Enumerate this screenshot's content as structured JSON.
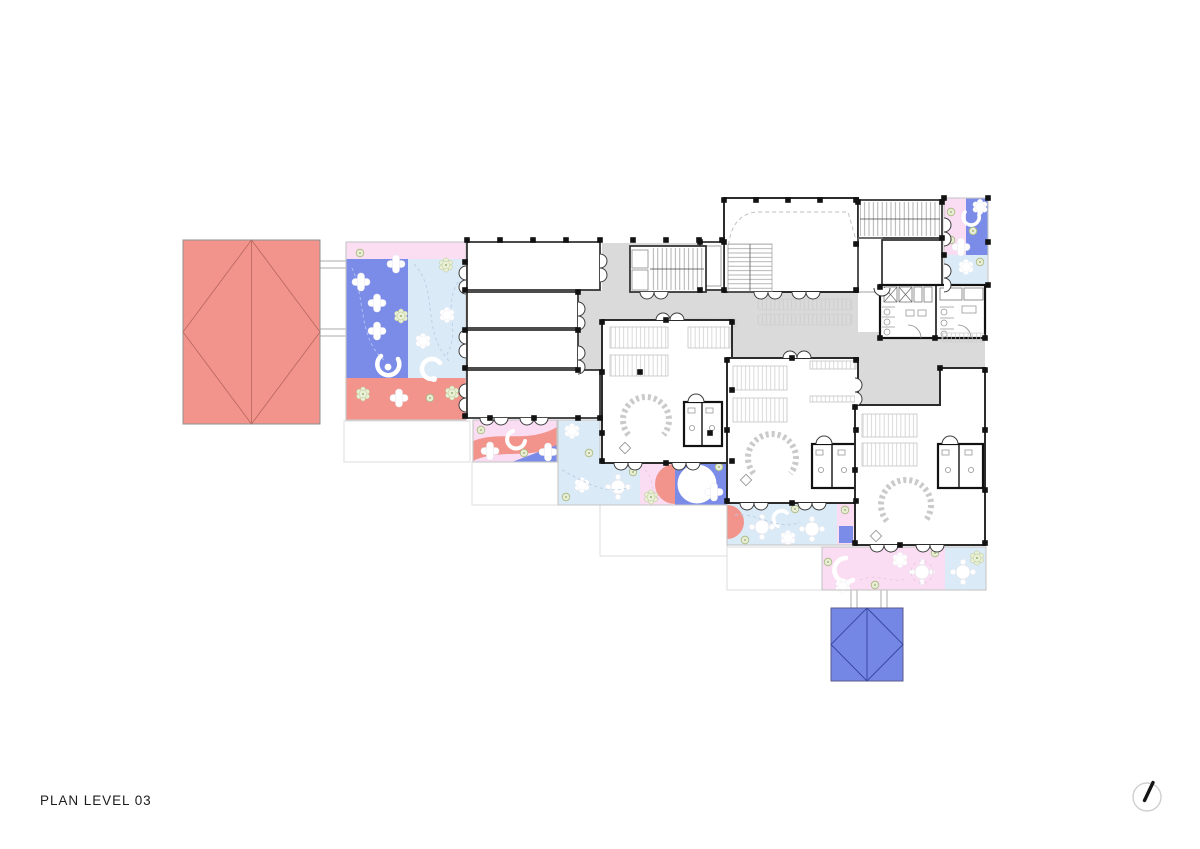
{
  "page": {
    "title": "PLAN LEVEL 03",
    "sheet_background": "#ffffff"
  },
  "colors": {
    "ink": "#1d1d1d",
    "wall": "#2c2c2c",
    "wall_heavy": "#121212",
    "corridor": "#dadada",
    "salmon": "#f2948c",
    "salmon_line": "#bc6a62",
    "periwinkle": "#7b8ce8",
    "roof_blue": "#7487e5",
    "roof_blue_line": "#36459e",
    "light_blue": "#daeaf6",
    "pink": "#fadcf3",
    "pink_light": "#fbdef2",
    "faint": "#dedede",
    "hatch": "#c9c9c9",
    "green_fill": "#e8edd6",
    "green_line": "#a9b77f",
    "dash_blue": "#b7c2f2",
    "dash_light_blue": "#b9cde6",
    "dash_pink": "#eacbe0",
    "north_ring": "#cfcfcf",
    "paper": "#ffffff"
  },
  "icons": {
    "north_indicator": "north-arrow-icon",
    "play_table": "cross-table-icon",
    "planter": "flower-icon",
    "round_table": "round-table-icon",
    "play_arc": "arc-icon"
  }
}
